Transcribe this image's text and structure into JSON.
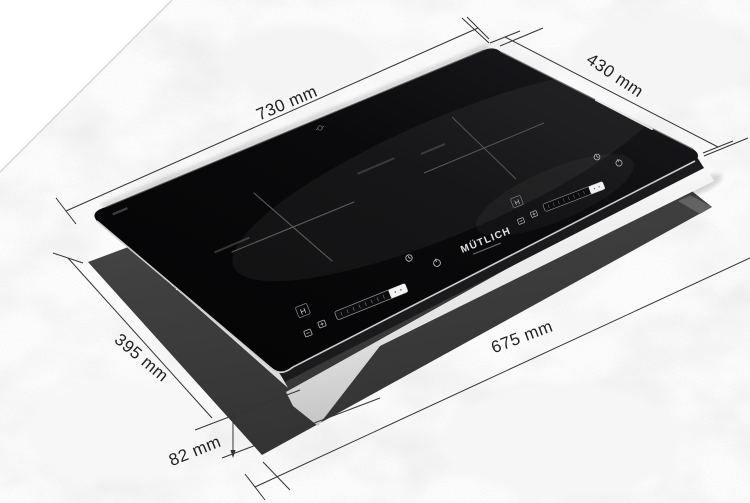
{
  "scene": {
    "description": "Induction hob installation dimension diagram on marble countertop",
    "background_color": "#ffffff",
    "countertop_color": "#ececec",
    "cutout_color": "#3f3f3f",
    "glass_color": "#0a0a0c",
    "body_color": "#f2f2f2",
    "dimension_line_color": "#333333"
  },
  "dimensions": {
    "hob_width": "730 mm",
    "hob_depth": "430 mm",
    "cutout_width": "675 mm",
    "cutout_depth": "395 mm",
    "install_height": "82 mm"
  },
  "hob": {
    "brand": "MÜTLICH",
    "zones": 2,
    "display": "H",
    "icons": [
      "plus-key-icon",
      "minus-key-icon",
      "timer-icon",
      "power-icon",
      "boost-segment",
      "zone-cross-marking"
    ]
  }
}
